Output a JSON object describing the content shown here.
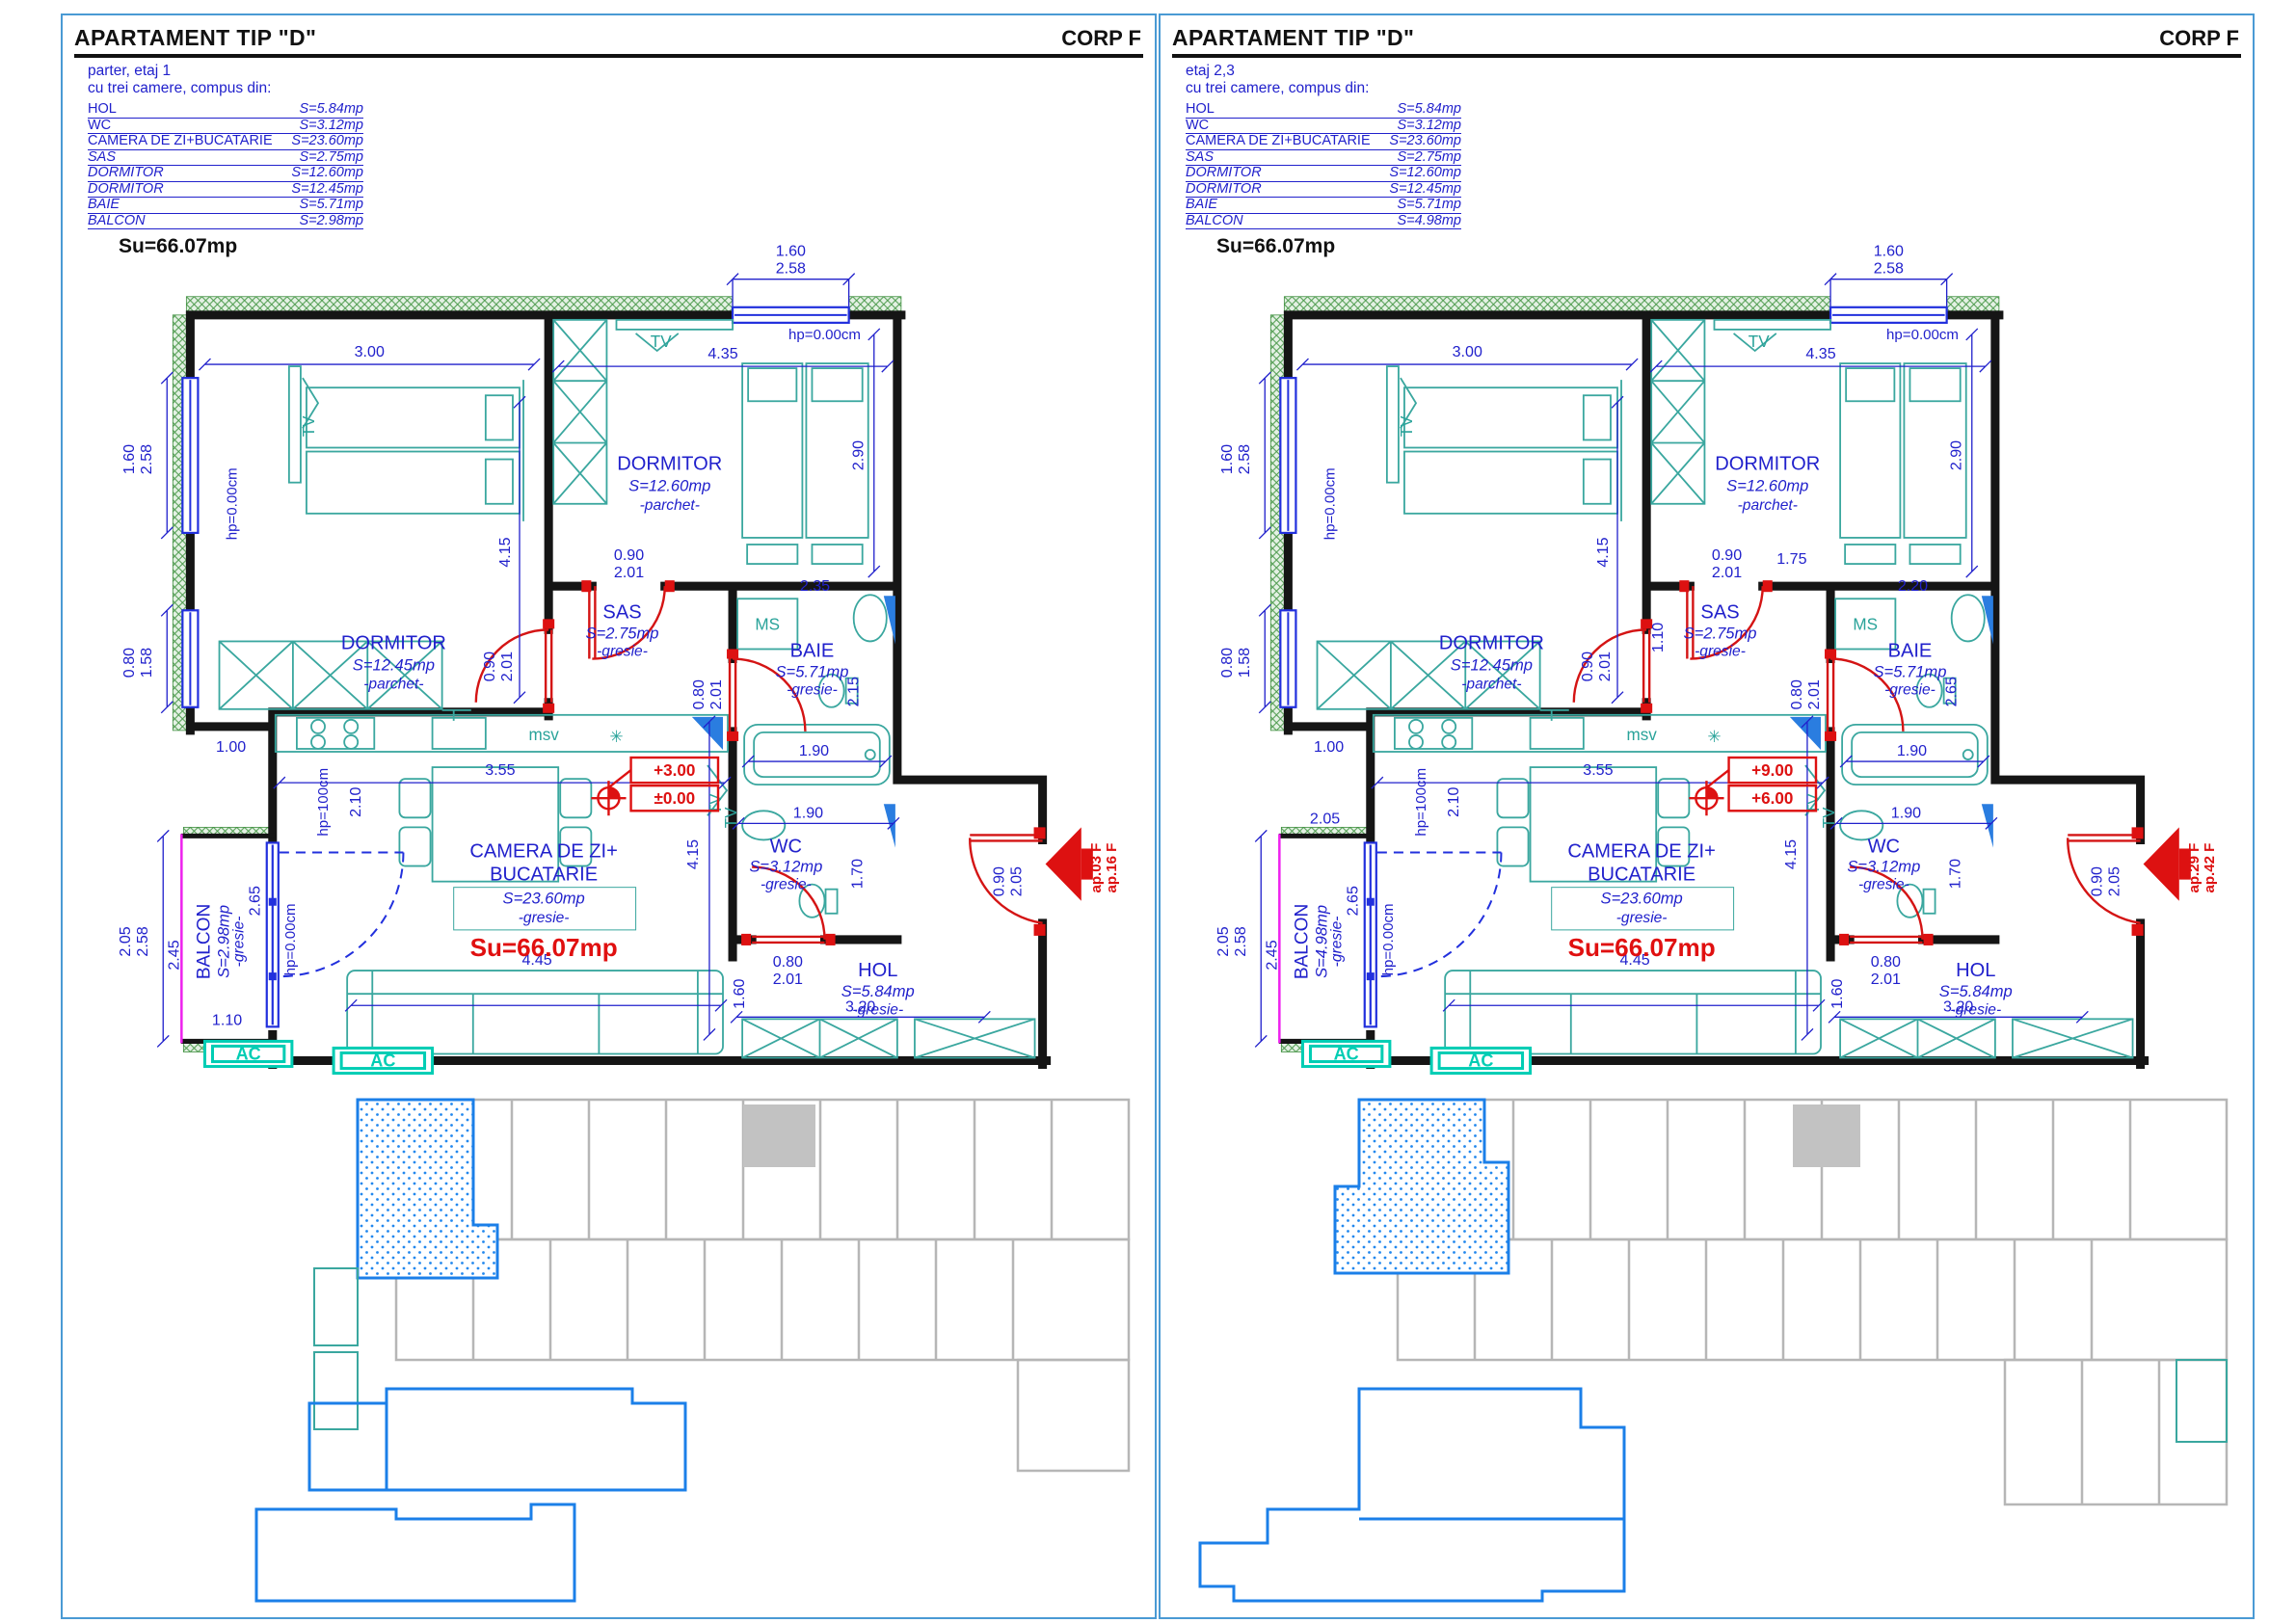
{
  "panels": [
    {
      "title": "APARTAMENT TIP \"D\"",
      "corp": "CORP F",
      "floor": "parter, etaj 1",
      "compose": "cu trei camere, compus din:",
      "rooms": [
        {
          "name": "HOL",
          "area": "S=5.84mp"
        },
        {
          "name": "WC",
          "area": "S=3.12mp"
        },
        {
          "name": "CAMERA DE ZI+BUCATARIE",
          "area": "S=23.60mp"
        },
        {
          "name": "SAS",
          "area": "S=2.75mp"
        },
        {
          "name": "DORMITOR",
          "area": "S=12.60mp"
        },
        {
          "name": "DORMITOR",
          "area": "S=12.45mp"
        },
        {
          "name": "BAIE",
          "area": "S=5.71mp"
        },
        {
          "name": "BALCON",
          "area": "S=2.98mp"
        }
      ],
      "total": "Su=66.07mp",
      "plan": {
        "total": "Su=66.07mp",
        "rooms": {
          "dormitor1": {
            "name": "DORMITOR",
            "area": "S=12.45mp",
            "finish": "-parchet-"
          },
          "dormitor2": {
            "name": "DORMITOR",
            "area": "S=12.60mp",
            "finish": "-parchet-"
          },
          "sas": {
            "name": "SAS",
            "area": "S=2.75mp",
            "finish": "-gresie-"
          },
          "baie": {
            "name": "BAIE",
            "area": "S=5.71mp",
            "finish": "-gresie-"
          },
          "wc": {
            "name": "WC",
            "area": "S=3.12mp",
            "finish": "-gresie-"
          },
          "living": {
            "name_line1": "CAMERA DE ZI+",
            "name_line2": "BUCATARIE",
            "area": "S=23.60mp",
            "finish": "-gresie-"
          },
          "hol": {
            "name": "HOL",
            "area": "S=5.84mp",
            "finish": "-gresie-"
          },
          "balcon": {
            "name": "BALCON",
            "area": "S=2.98mp",
            "finish": "-gresie-"
          }
        },
        "levels": {
          "top": "+3.00",
          "bottom": "±0.00"
        },
        "exit": {
          "line1": "ap.03 F",
          "line2": "ap.16 F"
        },
        "labels": {
          "tv": "TV",
          "ms": "MS",
          "msv": "msv",
          "ac": "AC",
          "hp0": "hp=0.00cm",
          "hp100": "hp=100cm",
          "asterisk": "✳"
        },
        "dims": {
          "top_win_w": "1.60",
          "top_win_h": "2.58",
          "dorm1_w": "3.00",
          "dorm1_h": "4.15",
          "dorm2_w": "4.35",
          "dorm2_h": "2.90",
          "door_w": "0.90",
          "door_h": "2.01",
          "ms_w": "2.35",
          "baie_h": "2.15",
          "bath_door_w": "0.80",
          "bath_door_h": "2.01",
          "tub_w": "1.90",
          "wc_w": "1.90",
          "wc_h": "1.70",
          "kitchen_w": "3.55",
          "kitchen_h": "2.10",
          "win_l1_w": "1.60",
          "win_l1_h": "2.58",
          "win_l2_w": "0.80",
          "win_l2_h": "1.58",
          "step": "1.00",
          "balc_pair_a": "2.05",
          "balc_pair_b": "2.58",
          "balc_w": "2.45",
          "balc_r": "2.65",
          "balc_bottom": "1.10",
          "living_h": "4.15",
          "sofa_w": "4.45",
          "hol_h": "1.60",
          "hol_w": "3.20",
          "entry_w": "0.90",
          "entry_h": "2.05"
        }
      }
    },
    {
      "title": "APARTAMENT TIP \"D\"",
      "corp": "CORP F",
      "floor": "etaj 2,3",
      "compose": "cu trei camere, compus din:",
      "rooms": [
        {
          "name": "HOL",
          "area": "S=5.84mp"
        },
        {
          "name": "WC",
          "area": "S=3.12mp"
        },
        {
          "name": "CAMERA DE ZI+BUCATARIE",
          "area": "S=23.60mp"
        },
        {
          "name": "SAS",
          "area": "S=2.75mp"
        },
        {
          "name": "DORMITOR",
          "area": "S=12.60mp"
        },
        {
          "name": "DORMITOR",
          "area": "S=12.45mp"
        },
        {
          "name": "BAIE",
          "area": "S=5.71mp"
        },
        {
          "name": "BALCON",
          "area": "S=4.98mp"
        }
      ],
      "total": "Su=66.07mp",
      "plan": {
        "total": "Su=66.07mp",
        "rooms": {
          "dormitor1": {
            "name": "DORMITOR",
            "area": "S=12.45mp",
            "finish": "-parchet-"
          },
          "dormitor2": {
            "name": "DORMITOR",
            "area": "S=12.60mp",
            "finish": "-parchet-"
          },
          "sas": {
            "name": "SAS",
            "area": "S=2.75mp",
            "finish": "-gresie-"
          },
          "baie": {
            "name": "BAIE",
            "area": "S=5.71mp",
            "finish": "-gresie-"
          },
          "wc": {
            "name": "WC",
            "area": "S=3.12mp",
            "finish": "-gresie-"
          },
          "living": {
            "name_line1": "CAMERA DE ZI+",
            "name_line2": "BUCATARIE",
            "area": "S=23.60mp",
            "finish": "-gresie-"
          },
          "hol": {
            "name": "HOL",
            "area": "S=5.84mp",
            "finish": "-gresie-"
          },
          "balcon": {
            "name": "BALCON",
            "area": "S=4.98mp",
            "finish": "-gresie-"
          }
        },
        "levels": {
          "top": "+9.00",
          "bottom": "+6.00"
        },
        "exit": {
          "line1": "ap.29 F",
          "line2": "ap.42 F"
        },
        "labels": {
          "tv": "TV",
          "ms": "MS",
          "msv": "msv",
          "ac": "AC",
          "hp0": "hp=0.00cm",
          "hp100": "hp=100cm",
          "asterisk": "✳"
        },
        "dims": {
          "top_win_w": "1.60",
          "top_win_h": "2.58",
          "dorm1_w": "3.00",
          "dorm1_h": "4.15",
          "dorm2_w": "4.35",
          "dorm2_h": "2.90",
          "door_w": "0.90",
          "door_h": "2.01",
          "sas_w": "1.75",
          "sas_h": "1.10",
          "ms_w": "2.20",
          "baie_h": "2.65",
          "bath_door_w": "0.80",
          "bath_door_h": "2.01",
          "tub_w": "1.90",
          "wc_w": "1.90",
          "wc_h": "1.70",
          "kitchen_w": "3.55",
          "kitchen_h": "2.10",
          "win_l1_w": "1.60",
          "win_l1_h": "2.58",
          "win_l2_w": "0.80",
          "win_l2_h": "1.58",
          "step": "1.00",
          "balc_top": "2.05",
          "balc_pair_a": "2.05",
          "balc_pair_b": "2.58",
          "balc_w": "2.45",
          "balc_r": "2.65",
          "living_h": "4.15",
          "sofa_w": "4.45",
          "hol_h": "1.60",
          "hol_w": "3.20",
          "entry_w": "0.90",
          "entry_h": "2.05"
        }
      }
    }
  ]
}
